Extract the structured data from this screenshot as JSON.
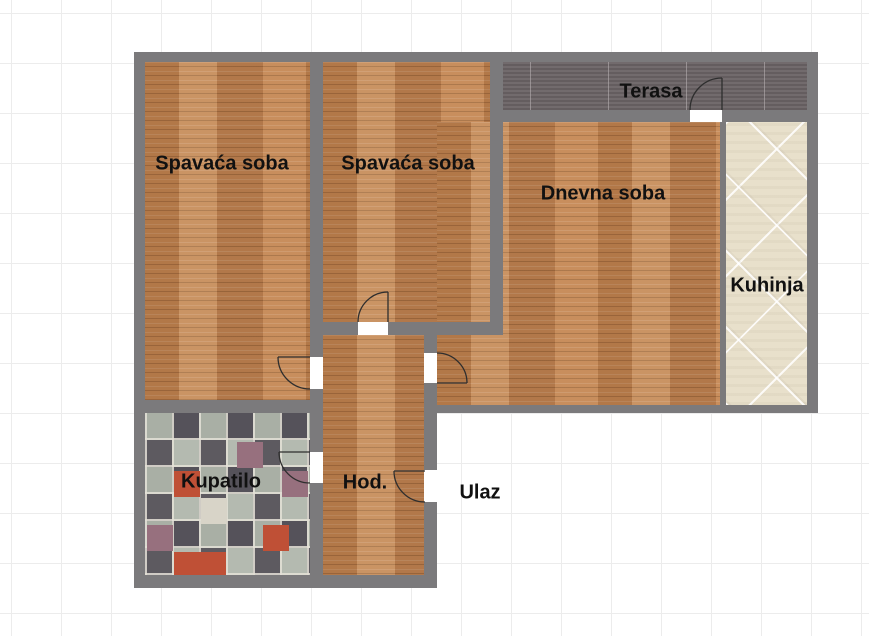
{
  "plan": {
    "rooms": {
      "bedroom1": "Spavaća soba",
      "bedroom2": "Spavaća soba",
      "living_room": "Dnevna soba",
      "kitchen": "Kuhinja",
      "terrace": "Terasa",
      "bathroom": "Kupatilo",
      "hallway": "Hod.",
      "entrance": "Ulaz"
    },
    "colors": {
      "wall": "#7b7a7c",
      "wood_floor": "#c08453",
      "terrace_tile": "#6a6365",
      "kitchen_tile": "#e8e0cb",
      "bathroom_tile_dark": "#55525a",
      "bathroom_tile_light": "#b4bab0",
      "bathroom_tile_red": "#bf5036",
      "bathroom_tile_mauve": "#97707e",
      "door_opening": "#ffffff",
      "label_text": "#111111",
      "background": "#ffffff"
    }
  }
}
